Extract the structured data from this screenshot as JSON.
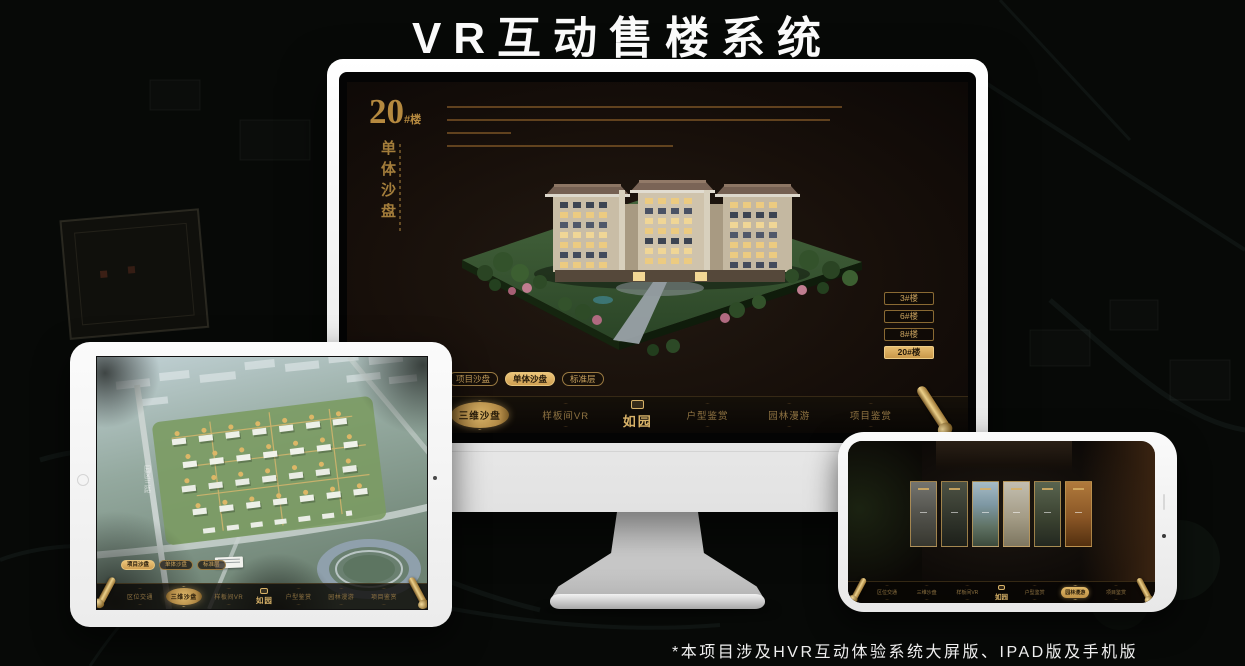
{
  "title": "VR互动售楼系统",
  "footnote": "*本项目涉及HVR互动体验系统大屏版、IPAD版及手机版",
  "logo": "如园",
  "colors": {
    "gold": "#c9a25e",
    "gold_bright": "#e3b968",
    "screen_bg": "#17110b",
    "device_white": "#f5f5f4"
  },
  "monitor": {
    "headline_number": "20",
    "headline_suffix": "#楼",
    "headline_vertical": "单体沙盘",
    "floor_buttons": [
      {
        "label": "3#楼",
        "active": false
      },
      {
        "label": "6#楼",
        "active": false
      },
      {
        "label": "8#楼",
        "active": false
      },
      {
        "label": "20#楼",
        "active": true
      }
    ],
    "tabs": [
      {
        "label": "项目沙盘",
        "active": false
      },
      {
        "label": "单体沙盘",
        "active": true
      },
      {
        "label": "标准层",
        "active": false
      }
    ],
    "nav_left": [
      {
        "label": "区位交通",
        "active": false
      },
      {
        "label": "三维沙盘",
        "active": true
      },
      {
        "label": "样板间VR",
        "active": false
      }
    ],
    "nav_right": [
      {
        "label": "户型鉴赏",
        "active": false
      },
      {
        "label": "园林漫游",
        "active": false
      },
      {
        "label": "项目鉴赏",
        "active": false
      }
    ]
  },
  "tablet": {
    "road_label": "园区三路",
    "tabs": [
      {
        "label": "项目沙盘",
        "active": true
      },
      {
        "label": "单体沙盘",
        "active": false
      },
      {
        "label": "标准层",
        "active": false
      }
    ],
    "nav_left": [
      {
        "label": "区位交通",
        "active": false
      },
      {
        "label": "三维沙盘",
        "active": true
      },
      {
        "label": "样板间VR",
        "active": false
      }
    ],
    "nav_right": [
      {
        "label": "户型鉴赏",
        "active": false
      },
      {
        "label": "园林漫游",
        "active": false
      },
      {
        "label": "项目鉴赏",
        "active": false
      }
    ]
  },
  "phone": {
    "nav_left": [
      {
        "label": "区位交通",
        "active": false
      },
      {
        "label": "三维沙盘",
        "active": false
      },
      {
        "label": "样板间VR",
        "active": false
      }
    ],
    "nav_right": [
      {
        "label": "户型鉴赏",
        "active": false
      },
      {
        "label": "园林漫游",
        "active": true
      },
      {
        "label": "项目鉴赏",
        "active": false
      }
    ]
  }
}
